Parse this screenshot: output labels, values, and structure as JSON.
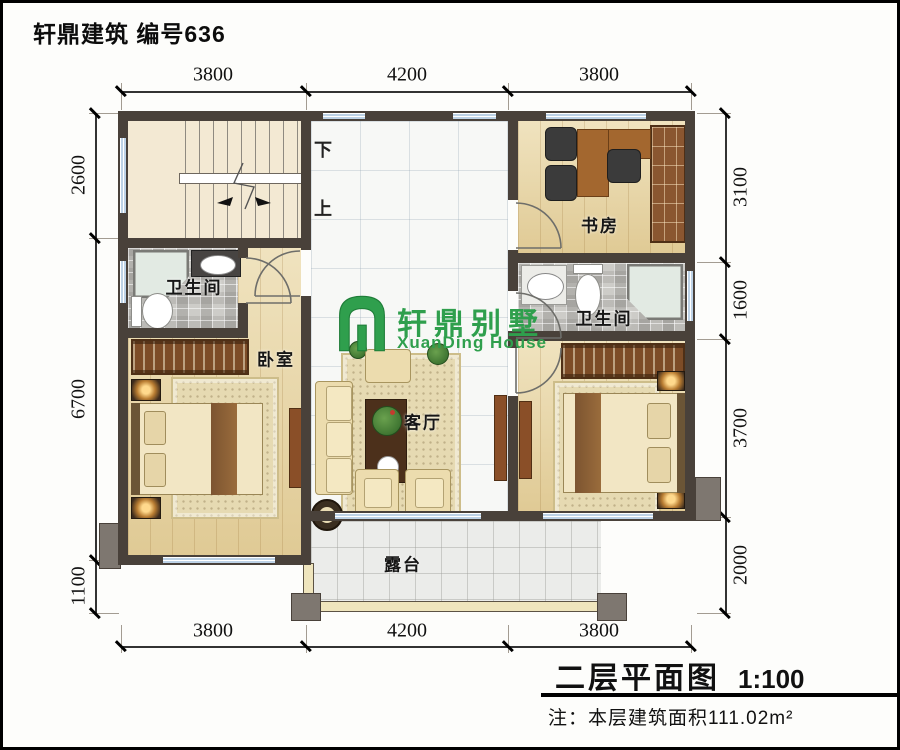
{
  "frame": {
    "page_title": "轩鼎建筑 编号636"
  },
  "logo": {
    "cn": "轩鼎别墅",
    "en": "XuanDing House",
    "color": "#2f9f4d"
  },
  "rooms": {
    "study": "书房",
    "bath_left": "卫生间",
    "bath_right": "卫生间",
    "bedroom": "卧室",
    "living": "客厅",
    "terrace": "露台"
  },
  "stairs": {
    "down": "下",
    "up": "上"
  },
  "dims": {
    "top": [
      "3800",
      "4200",
      "3800"
    ],
    "bottom": [
      "3800",
      "4200",
      "3800"
    ],
    "left": [
      "2600",
      "6700",
      "1100"
    ],
    "right": [
      "3100",
      "1600",
      "3700",
      "2000"
    ]
  },
  "titleblock": {
    "name": "二层平面图",
    "scale": "1:100",
    "note": "注：本层建筑面积111.02m²"
  },
  "colors": {
    "wall": "#49413a",
    "logo_green": "#2f9f4d",
    "wood_floor": "#ead8a6",
    "window_blue": "#bdd2e6"
  }
}
